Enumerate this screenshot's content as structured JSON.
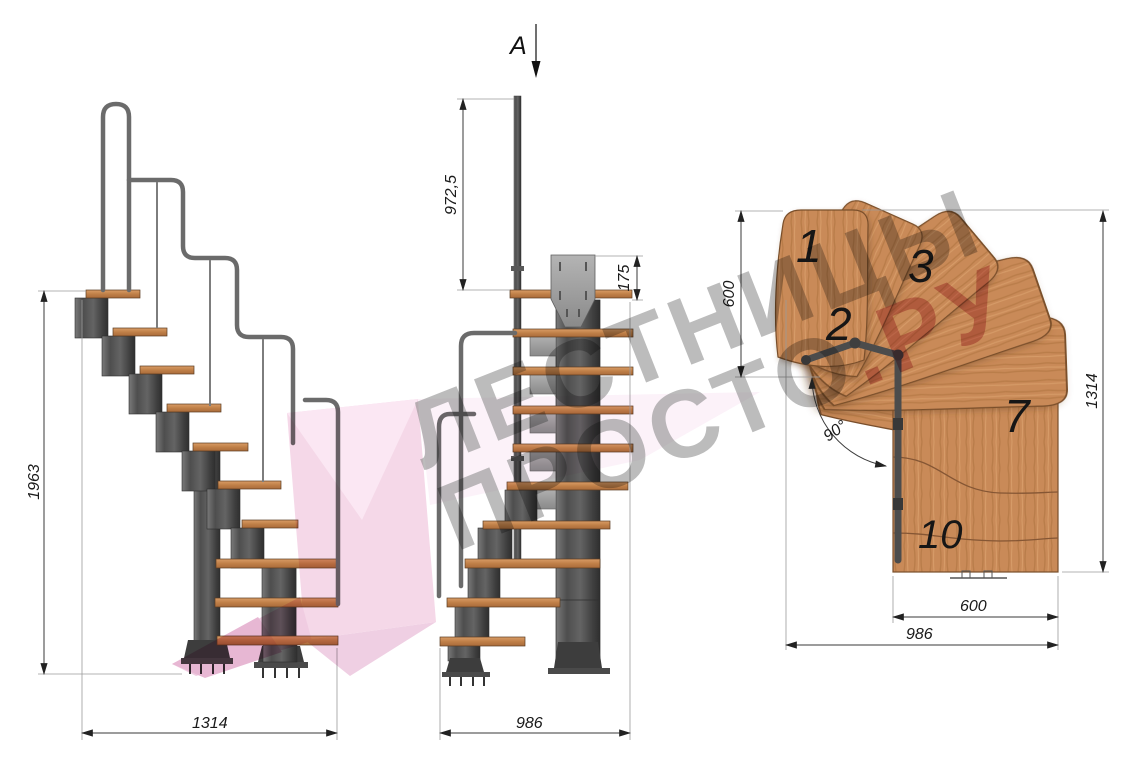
{
  "watermark": {
    "line1": "ЛЕСТНИЦЫ",
    "line2": "ПРОСТО",
    "line2_accent": ".РУ"
  },
  "section_view": {
    "label": "A"
  },
  "side_view": {
    "dim_height": "1963",
    "dim_length": "1314"
  },
  "front_view": {
    "dim_post_height": "972,5",
    "dim_bracket_height": "175",
    "dim_width": "986"
  },
  "plan_view": {
    "dim_turn_depth": "600",
    "dim_total_length": "1314",
    "dim_flight_width": "600",
    "dim_total_width": "986",
    "turn_angle": "90°",
    "treads": [
      {
        "label": "1"
      },
      {
        "label": "2"
      },
      {
        "label": "3"
      },
      {
        "label": "7"
      },
      {
        "label": "10"
      }
    ]
  },
  "colors": {
    "wood": "#c98a58",
    "wood_edge": "#7a4f2c",
    "metal_dark": "#4a4a4a",
    "rail_gray": "#6b6b6b",
    "dim_line": "#3a3a3a",
    "watermark_gray": "#8f8f8f",
    "watermark_red": "#cc6f7d",
    "logo_pink": "#f3cfe3"
  }
}
